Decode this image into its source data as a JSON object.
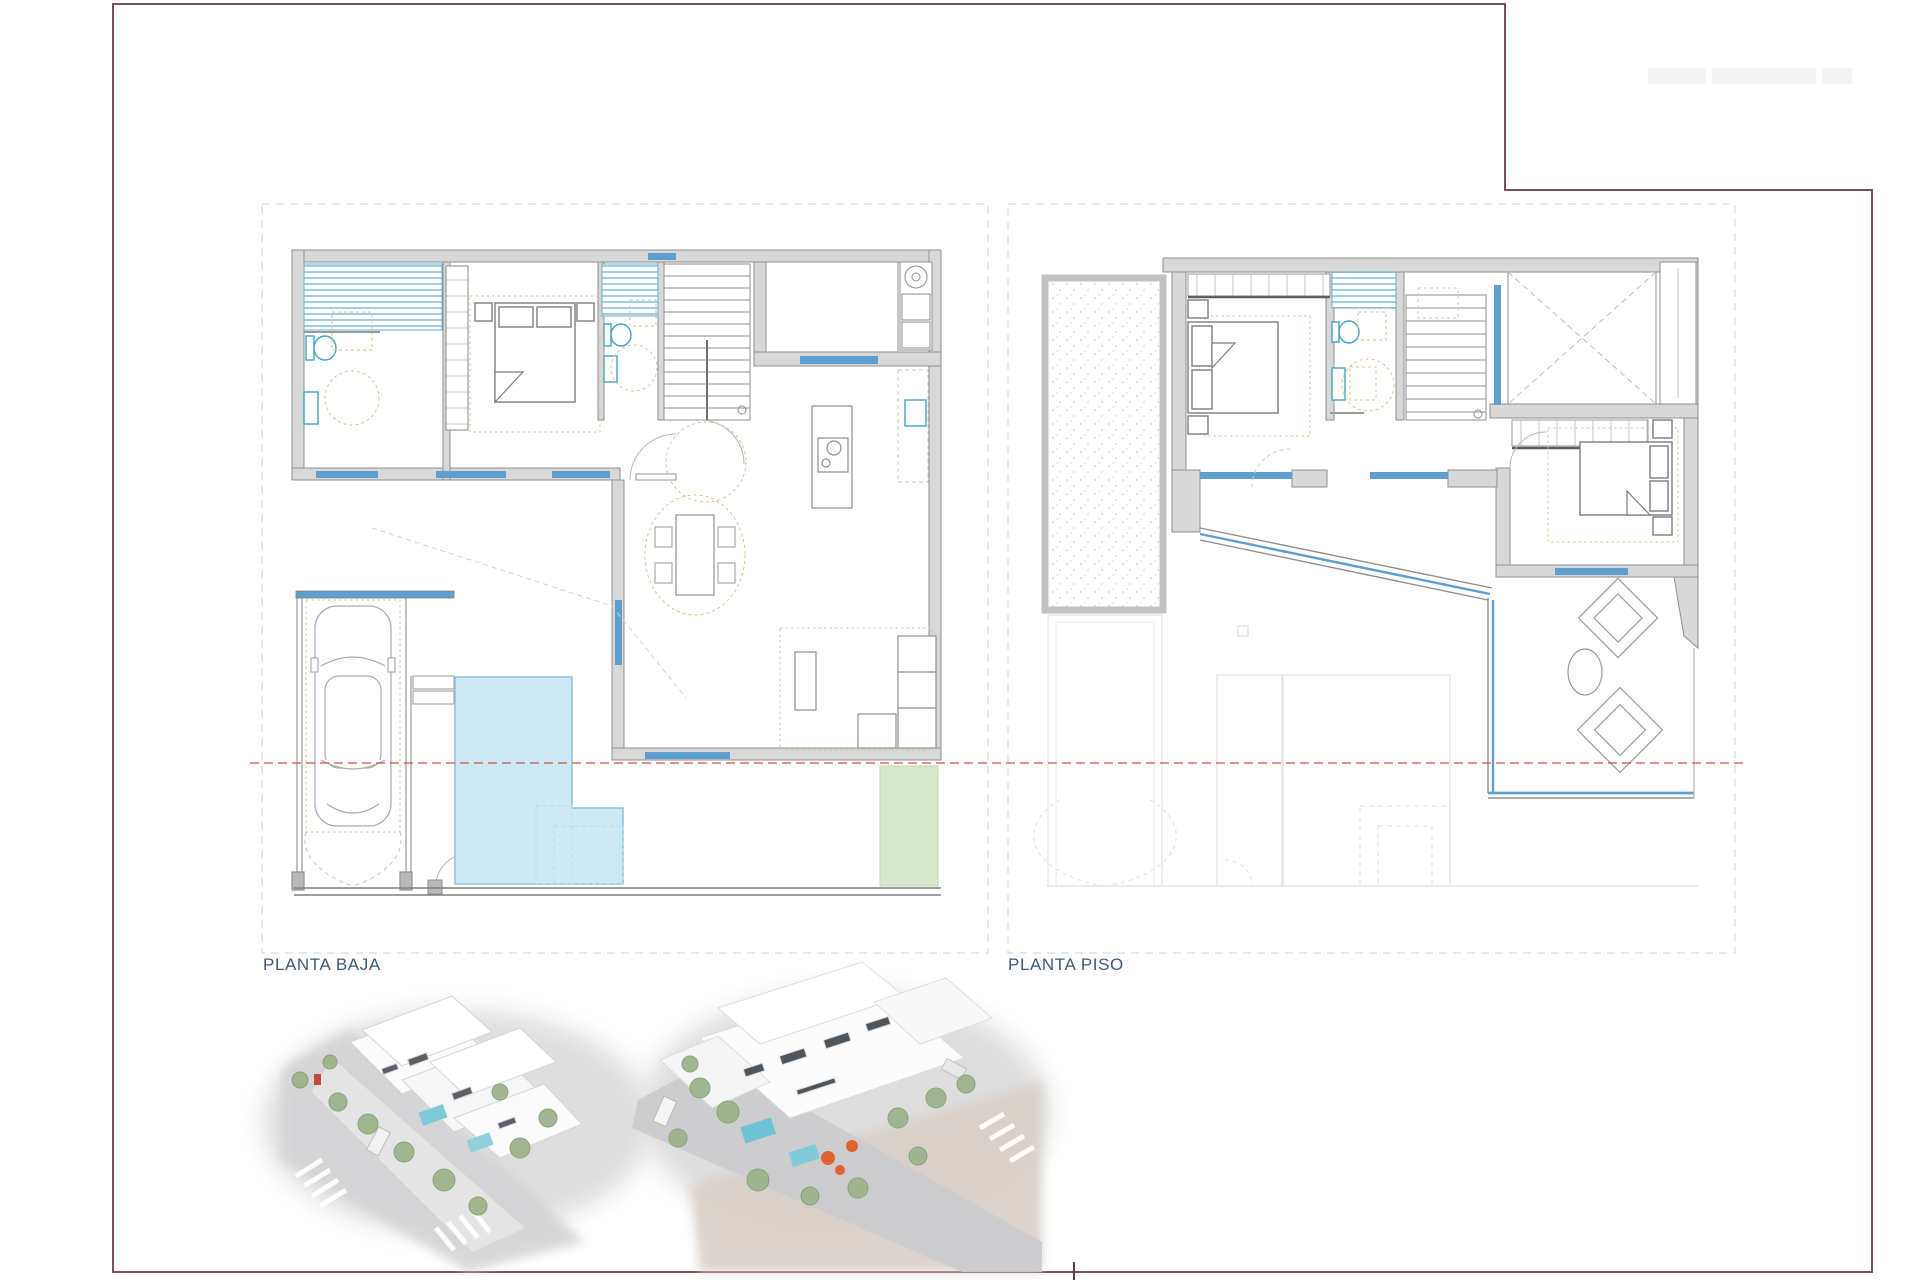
{
  "page": {
    "type": "architectural plan sheet",
    "labels": {
      "ground_floor": "PLANTA BAJA",
      "upper_floor": "PLANTA PISO"
    },
    "colors": {
      "frame": "#7a525a",
      "wall_fill": "#d8d8d8",
      "wall_stroke": "#8f8f8f",
      "window_blue": "#5f9fd0",
      "shower_stripe": "#9fcfe4",
      "fixture_teal": "#3fa8c0",
      "pool_fill": "#cde9f6",
      "pool_stroke": "#8cc3de",
      "lawn_green": "#d7e7cb",
      "rug_dash_tan": "#dbc28a",
      "section_line_red": "#cc5544",
      "boundary_dash": "#d9d9d9",
      "ghost_line": "#e2e2e2",
      "label_text": "#3d5c77"
    }
  }
}
